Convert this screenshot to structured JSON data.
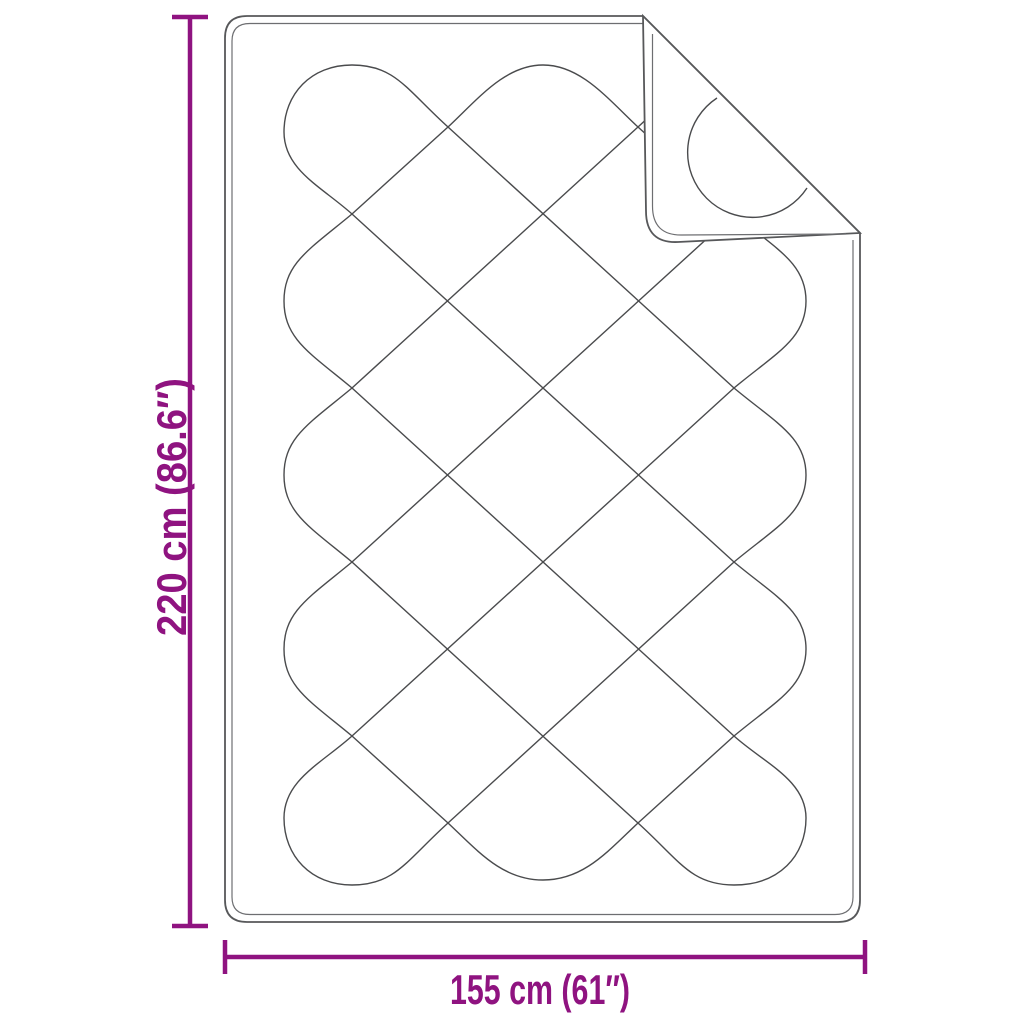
{
  "diagram": {
    "description": "Line drawing of a quilted blanket (diamond stitch pattern) with its top-right corner folded over, annotated with product dimensions",
    "dimension_labels": {
      "height": "220 cm (86.6″)",
      "width": "155 cm (61″)"
    },
    "colors": {
      "dimension_accent": "#8F1380",
      "outline_gray": "#57585a",
      "piping_gray": "#6d6e71",
      "pattern_gray": "#4a4b4d",
      "background": "#ffffff"
    }
  }
}
